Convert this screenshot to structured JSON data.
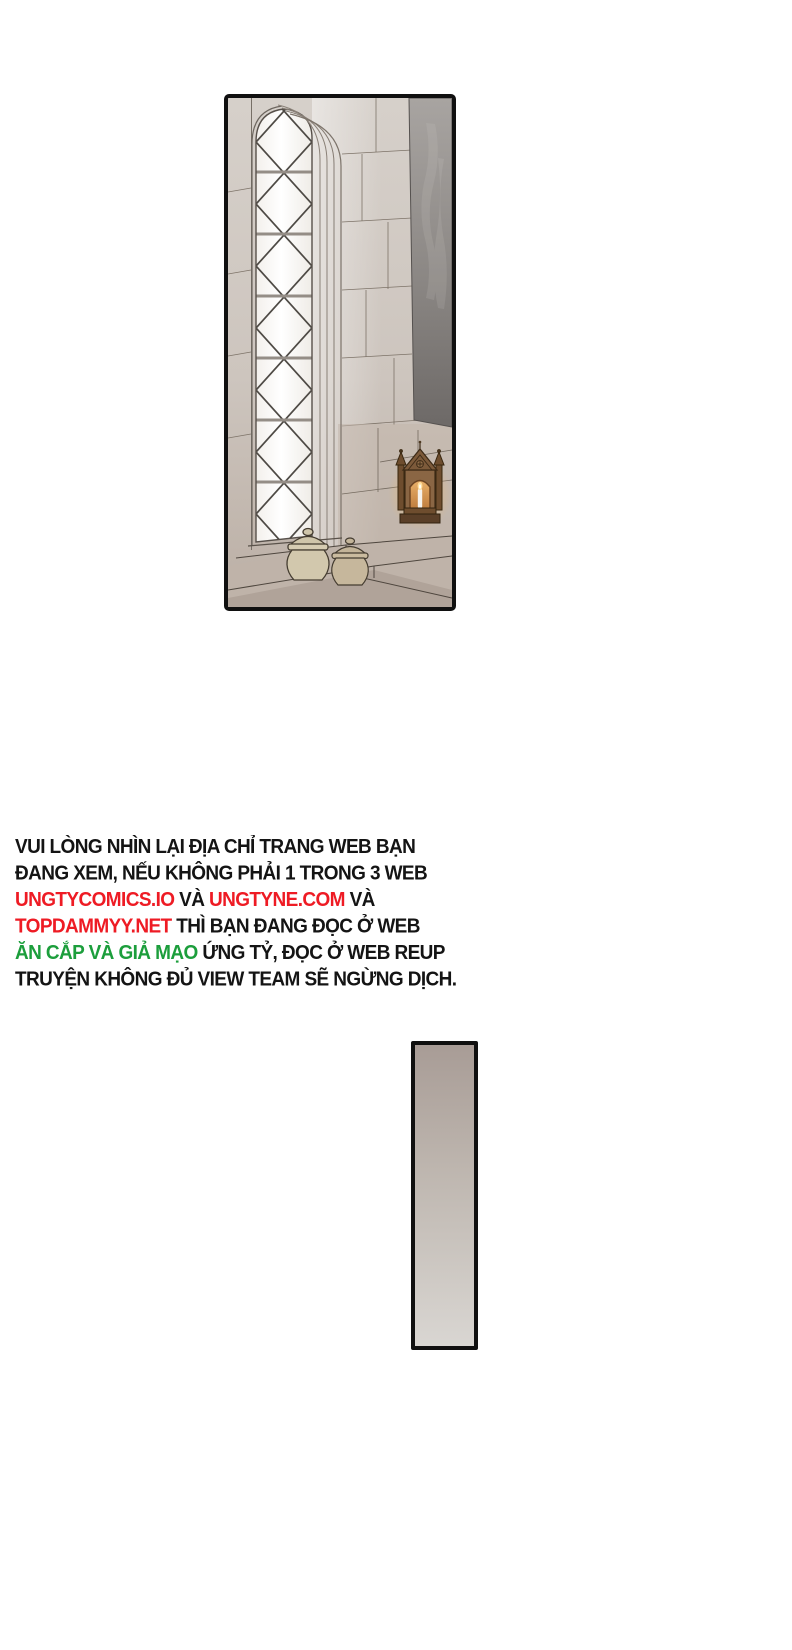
{
  "page": {
    "background": "#ffffff"
  },
  "colors": {
    "notice_black": "#141414",
    "notice_red": "#ee1b24",
    "notice_green": "#1c9e3c",
    "panel_border": "#101010"
  },
  "scene": {
    "elements": [
      "gothic-lattice-window",
      "stone-wall",
      "hanging-tapestry",
      "ceramic-jar",
      "ceramic-jar",
      "candle-shrine",
      "stone-steps"
    ]
  },
  "notice": {
    "lines": [
      {
        "segments": [
          {
            "text": "VUI LÒNG NHÌN LẠI ĐỊA CHỈ TRANG WEB BẠN",
            "color": "black"
          }
        ]
      },
      {
        "segments": [
          {
            "text": "ĐANG XEM, NẾU KHÔNG PHẢI 1 TRONG 3 WEB",
            "color": "black"
          }
        ]
      },
      {
        "segments": [
          {
            "text": "UNGTYCOMICS.IO",
            "color": "red"
          },
          {
            "text": " VÀ ",
            "color": "black"
          },
          {
            "text": "UNGTYNE.COM",
            "color": "red"
          },
          {
            "text": " VÀ",
            "color": "black"
          }
        ]
      },
      {
        "segments": [
          {
            "text": "TOPDAMMYY.NET",
            "color": "red"
          },
          {
            "text": " THÌ BẠN ĐANG ĐỌC Ở WEB",
            "color": "black"
          }
        ]
      },
      {
        "segments": [
          {
            "text": "ĂN CẮP VÀ GIẢ MẠO",
            "color": "green"
          },
          {
            "text": " ỨNG TỶ, ĐỌC Ở WEB REUP",
            "color": "black"
          }
        ]
      },
      {
        "segments": [
          {
            "text": "TRUYỆN KHÔNG ĐỦ VIEW TEAM SẼ NGỪNG DỊCH.",
            "color": "black"
          }
        ]
      }
    ]
  }
}
